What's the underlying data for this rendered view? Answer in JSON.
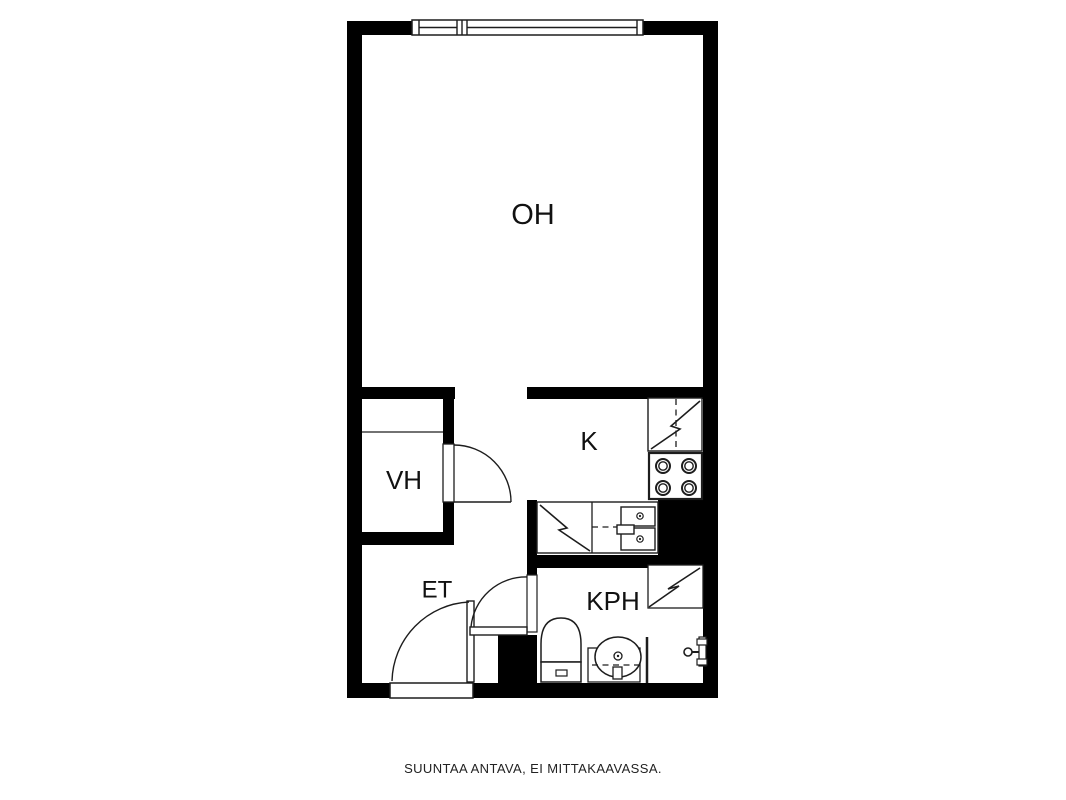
{
  "caption": "SUUNTAA ANTAVA, EI MITTAKAAVASSA.",
  "colors": {
    "wall": "#000000",
    "line": "#1d1d1d",
    "background": "#ffffff",
    "text": "#111111"
  },
  "rooms": [
    {
      "name": "room-label-living-room",
      "label": "OH",
      "x": 533,
      "y": 214,
      "size": 29
    },
    {
      "name": "room-label-closet",
      "label": "VH",
      "x": 404,
      "y": 480,
      "size": 26
    },
    {
      "name": "room-label-kitchen",
      "label": "K",
      "x": 589,
      "y": 441,
      "size": 26
    },
    {
      "name": "room-label-hallway",
      "label": "ET",
      "x": 437,
      "y": 589,
      "size": 24
    },
    {
      "name": "room-label-bathroom",
      "label": "KPH",
      "x": 613,
      "y": 601,
      "size": 26
    }
  ],
  "floorplan": {
    "shapes": [
      {
        "t": "wall",
        "n": "wall-left",
        "r": [
          347,
          21,
          15,
          677
        ]
      },
      {
        "t": "wall",
        "n": "wall-top-left",
        "r": [
          347,
          21,
          65,
          14
        ]
      },
      {
        "t": "wall",
        "n": "wall-top-right",
        "r": [
          643,
          21,
          75,
          14
        ]
      },
      {
        "t": "wall",
        "n": "wall-right",
        "r": [
          703,
          21,
          15,
          677
        ]
      },
      {
        "t": "wall",
        "n": "wall-bottom-left",
        "r": [
          347,
          683,
          44,
          15
        ]
      },
      {
        "t": "wall",
        "n": "wall-bottom-right",
        "r": [
          473,
          683,
          245,
          15
        ]
      },
      {
        "t": "wall",
        "n": "wall-closet-top",
        "r": [
          362,
          387,
          93,
          12
        ]
      },
      {
        "t": "wall",
        "n": "wall-kitchen-top",
        "r": [
          527,
          387,
          176,
          12
        ]
      },
      {
        "t": "wall",
        "n": "wall-closet-right-upper",
        "r": [
          443,
          387,
          11,
          57
        ]
      },
      {
        "t": "wall",
        "n": "wall-closet-right-lower",
        "r": [
          443,
          502,
          11,
          43
        ]
      },
      {
        "t": "wall",
        "n": "wall-closet-bottom",
        "r": [
          362,
          532,
          92,
          13
        ]
      },
      {
        "t": "wall",
        "n": "wall-divider-upper",
        "r": [
          527,
          500,
          10,
          77
        ]
      },
      {
        "t": "wall",
        "n": "wall-divider-block",
        "r": [
          498,
          635,
          39,
          48
        ]
      },
      {
        "t": "wall",
        "n": "wall-kitchen-shaft",
        "r": [
          658,
          500,
          45,
          55
        ]
      },
      {
        "t": "wall",
        "n": "wall-kitchen-bathroom",
        "r": [
          527,
          555,
          176,
          13
        ]
      },
      {
        "t": "wrect",
        "n": "window-frame",
        "r": [
          412,
          20,
          231,
          15
        ],
        "sw": 1.5
      },
      {
        "t": "line",
        "n": "window-mullion-1",
        "p": [
          419,
          20.5,
          419,
          34.5
        ]
      },
      {
        "t": "line",
        "n": "window-mullion-2",
        "p": [
          457,
          20.5,
          457,
          34.5
        ]
      },
      {
        "t": "line",
        "n": "window-mullion-3",
        "p": [
          462,
          20.5,
          462,
          34.5
        ]
      },
      {
        "t": "line",
        "n": "window-mullion-4",
        "p": [
          467,
          20.5,
          467,
          34.5
        ]
      },
      {
        "t": "line",
        "n": "window-mullion-5",
        "p": [
          637,
          20.5,
          637,
          34.5
        ]
      },
      {
        "t": "line",
        "n": "window-glass-left",
        "p": [
          419,
          27.5,
          457,
          27.5
        ]
      },
      {
        "t": "line",
        "n": "window-glass-right",
        "p": [
          467,
          27.5,
          637,
          27.5
        ]
      },
      {
        "t": "line",
        "n": "closet-shelf-line",
        "p": [
          362,
          432,
          443,
          432
        ],
        "sw": 1.3
      },
      {
        "t": "wrect",
        "n": "closet-door-opening",
        "r": [
          443,
          444,
          11,
          58
        ],
        "sw": 1.3
      },
      {
        "t": "line",
        "n": "closet-door-leaf",
        "p": [
          454,
          502,
          511,
          502
        ],
        "sw": 1.5
      },
      {
        "t": "path",
        "n": "closet-door-arc",
        "d": "M 454 445 A 57 57 0 0 1 511 502"
      },
      {
        "t": "wrect",
        "n": "entrance-door-opening",
        "r": [
          390,
          683,
          83,
          15
        ],
        "sw": 1.5
      },
      {
        "t": "wrect",
        "n": "entrance-door-leaf",
        "r": [
          467,
          601,
          7,
          81
        ],
        "sw": 1.4
      },
      {
        "t": "path",
        "n": "entrance-door-arc",
        "d": "M 392 681 A 81 81 0 0 1 469 602"
      },
      {
        "t": "wrect",
        "n": "bathroom-door-opening",
        "r": [
          527,
          575,
          10,
          57
        ],
        "sw": 1.2
      },
      {
        "t": "wrect",
        "n": "bathroom-door-leaf",
        "r": [
          470,
          627,
          57,
          8
        ],
        "sw": 1.4
      },
      {
        "t": "path",
        "n": "bathroom-door-arc",
        "d": "M 471 627 A 55 55 0 0 1 527 577"
      },
      {
        "t": "wrect",
        "n": "fridge",
        "r": [
          648,
          398,
          54,
          53
        ],
        "sw": 1.4
      },
      {
        "t": "poly",
        "n": "fridge-zigzag",
        "pts": [
          [
            700,
            401
          ],
          [
            671,
            426
          ],
          [
            680,
            429
          ],
          [
            651,
            449
          ]
        ]
      },
      {
        "t": "dline",
        "n": "fridge-divider",
        "p": [
          676,
          399,
          676,
          450
        ]
      },
      {
        "t": "wrect",
        "n": "stove",
        "r": [
          649,
          453,
          53,
          46
        ],
        "sw": 2.2
      },
      {
        "t": "circle",
        "n": "stove-burner-outer",
        "c": [
          663,
          466,
          7,
          2
        ]
      },
      {
        "t": "circle",
        "n": "stove-burner-inner",
        "c": [
          663,
          466,
          4.2,
          1.4
        ]
      },
      {
        "t": "circle",
        "n": "stove-burner-outer",
        "c": [
          689,
          466,
          7,
          2
        ]
      },
      {
        "t": "circle",
        "n": "stove-burner-inner",
        "c": [
          689,
          466,
          4.2,
          1.4
        ]
      },
      {
        "t": "circle",
        "n": "stove-burner-outer",
        "c": [
          663,
          488,
          7,
          2
        ]
      },
      {
        "t": "circle",
        "n": "stove-burner-inner",
        "c": [
          663,
          488,
          4.2,
          1.4
        ]
      },
      {
        "t": "circle",
        "n": "stove-burner-outer",
        "c": [
          689,
          488,
          7,
          2
        ]
      },
      {
        "t": "circle",
        "n": "stove-burner-inner",
        "c": [
          689,
          488,
          4.2,
          1.4
        ]
      },
      {
        "t": "wrect",
        "n": "kitchen-counter",
        "r": [
          537,
          502,
          121,
          51
        ],
        "sw": 1.4
      },
      {
        "t": "line",
        "n": "dishwasher-edge",
        "p": [
          592,
          502,
          592,
          553
        ],
        "sw": 1.3
      },
      {
        "t": "poly",
        "n": "dishwasher-zigzag",
        "pts": [
          [
            540,
            505
          ],
          [
            567,
            528
          ],
          [
            559,
            530
          ],
          [
            590,
            551
          ]
        ]
      },
      {
        "t": "dline",
        "n": "counter-centerline",
        "p": [
          592,
          527,
          620,
          527
        ]
      },
      {
        "t": "wrect",
        "n": "sink-basin-top",
        "r": [
          621,
          507,
          34,
          19
        ],
        "sw": 1.4
      },
      {
        "t": "wrect",
        "n": "sink-basin-bottom",
        "r": [
          621,
          528,
          34,
          22
        ],
        "sw": 1.4
      },
      {
        "t": "circle",
        "n": "sink-drain",
        "c": [
          640,
          516,
          3.2,
          1.2
        ]
      },
      {
        "t": "circle",
        "n": "sink-drain-dot",
        "c": [
          640,
          516,
          1.1,
          0
        ],
        "fill": true
      },
      {
        "t": "circle",
        "n": "sink-drain",
        "c": [
          640,
          539,
          3.2,
          1.2
        ]
      },
      {
        "t": "circle",
        "n": "sink-drain-dot",
        "c": [
          640,
          539,
          1.1,
          0
        ],
        "fill": true
      },
      {
        "t": "wrect",
        "n": "sink-tap",
        "r": [
          617,
          525,
          17,
          9
        ],
        "sw": 1.4
      },
      {
        "t": "wrect",
        "n": "shower-cabinet",
        "r": [
          648,
          565,
          55,
          43
        ],
        "sw": 1.3
      },
      {
        "t": "poly",
        "n": "shower-zigzag",
        "pts": [
          [
            700,
            568
          ],
          [
            668,
            589
          ],
          [
            679,
            586
          ],
          [
            649,
            607
          ]
        ]
      },
      {
        "t": "path",
        "n": "toilet-bowl",
        "fill": true,
        "d": "M 541 662 L 541 644 Q 541 618 561 618 Q 581 618 581 644 L 581 662 Z",
        "sw": 1.5
      },
      {
        "t": "wrect",
        "n": "toilet-tank",
        "r": [
          541,
          662,
          40,
          20
        ],
        "sw": 1.5
      },
      {
        "t": "wrect",
        "n": "toilet-flush-button",
        "r": [
          556,
          670,
          11,
          6
        ],
        "sw": 1.2
      },
      {
        "t": "wrect",
        "n": "washbasin-counter",
        "r": [
          588,
          648,
          52,
          34
        ],
        "sw": 1.3
      },
      {
        "t": "ellipse",
        "n": "washbasin-bowl",
        "e": [
          618,
          657,
          23,
          20
        ],
        "sw": 1.5
      },
      {
        "t": "circle",
        "n": "washbasin-drain",
        "c": [
          618,
          656,
          4,
          1.3
        ]
      },
      {
        "t": "circle",
        "n": "washbasin-drain-dot",
        "c": [
          618,
          656,
          1.2,
          0
        ],
        "fill": true
      },
      {
        "t": "dline",
        "n": "washbasin-centerline",
        "p": [
          592,
          665,
          640,
          665
        ]
      },
      {
        "t": "wrect",
        "n": "washbasin-tap",
        "r": [
          613,
          667,
          9,
          12
        ],
        "sw": 1.3
      },
      {
        "t": "line",
        "n": "shower-screen",
        "p": [
          647,
          637,
          647,
          683
        ],
        "sw": 2.5
      },
      {
        "t": "wrect",
        "n": "wall-fixture-bar",
        "r": [
          699,
          637,
          7,
          29
        ],
        "sw": 1.2
      },
      {
        "t": "wrect",
        "n": "wall-fixture-cap-top",
        "r": [
          697,
          639,
          10,
          6
        ],
        "sw": 1.2
      },
      {
        "t": "wrect",
        "n": "wall-fixture-cap-bottom",
        "r": [
          697,
          659,
          10,
          6
        ],
        "sw": 1.2
      },
      {
        "t": "line",
        "n": "wall-fixture-stem",
        "p": [
          692,
          652,
          699,
          652
        ],
        "sw": 2
      },
      {
        "t": "circle",
        "n": "wall-fixture-knob",
        "c": [
          688,
          652,
          4,
          1.6
        ]
      }
    ]
  }
}
